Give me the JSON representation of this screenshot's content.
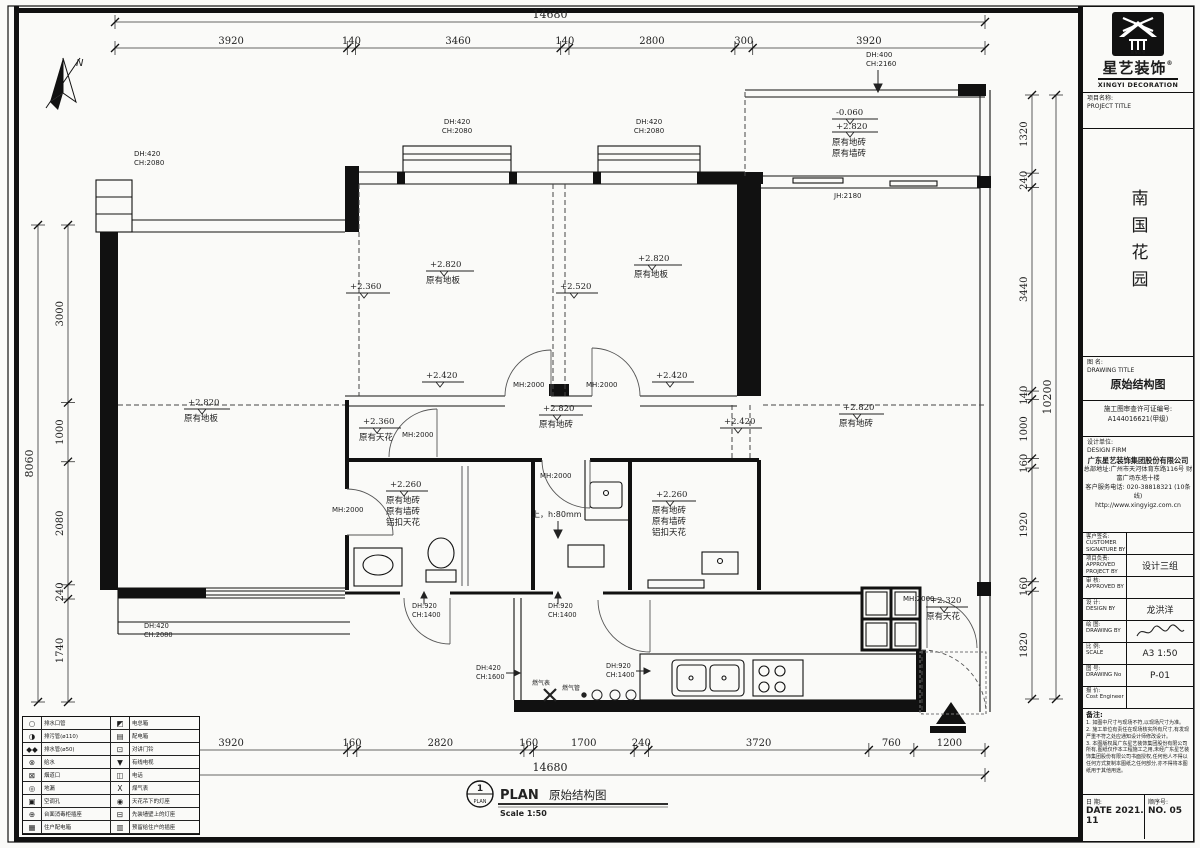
{
  "north_label": "N",
  "dims": {
    "top": {
      "total": "14680",
      "segments": [
        "3920",
        "140",
        "3460",
        "140",
        "2800",
        "300",
        "3920"
      ]
    },
    "bottom": {
      "total": "14680",
      "segments": [
        "3920",
        "160",
        "2820",
        "160",
        "1700",
        "240",
        "3720",
        "760",
        "1200"
      ]
    },
    "left": {
      "total": "8060",
      "segments": [
        "3000",
        "1000",
        "2080",
        "240",
        "1740"
      ]
    },
    "right": {
      "total": "10200",
      "segments": [
        "1320",
        "240",
        "3440",
        "140",
        "1000",
        "160",
        "1920",
        "160",
        "1820"
      ]
    }
  },
  "openings": {
    "win_tl": [
      "DH:420",
      "CH:2080"
    ],
    "bayA": [
      "DH:420",
      "CH:2080"
    ],
    "bayB": [
      "DH:420",
      "CH:2080"
    ],
    "balc": [
      "DH:400",
      "CH:2160"
    ],
    "jh": "JH:2180",
    "mh": "MH:2000",
    "d_bath1": [
      "DH:920",
      "CH:1400"
    ],
    "d_hall": [
      "DH:920",
      "CH:1400"
    ],
    "w_kit": [
      "DH:420",
      "CH:1600"
    ],
    "d_kit": [
      "DH:920",
      "CH:1400"
    ],
    "win_bl": [
      "DH:420",
      "CH:2080"
    ]
  },
  "levels": {
    "bedA": {
      "lv": "+2.820",
      "floor": "原有地板"
    },
    "bedA_edge": "+2.360",
    "bedB": {
      "lv": "+2.820",
      "floor": "原有地板"
    },
    "bedB_edge": "+2.520",
    "doorA_lv": "+2.420",
    "doorB_lv": "+2.420",
    "right_edge_lv": "+2.420",
    "balcony": {
      "lv1": "-0.060",
      "lv2": "+2.820",
      "t1": "原有地砖",
      "t2": "原有墙砖"
    },
    "living": {
      "lv": "+2.820",
      "floor": "原有地板"
    },
    "hall": {
      "lv": "+2.360",
      "ceil": "原有天花"
    },
    "dining": {
      "lv": "+2.820",
      "floor": "原有地砖"
    },
    "rightroom": {
      "lv": "+2.820",
      "floor": "原有地砖"
    },
    "bath1": {
      "lv": "+2.260",
      "t1": "原有地砖",
      "t2": "原有墙砖",
      "t3": "铝扣天花"
    },
    "bath2": {
      "lv": "+2.260",
      "t1": "原有地砖",
      "t2": "原有墙砖",
      "t3": "铝扣天花"
    },
    "entry": {
      "lv": "+2.320",
      "ceil": "原有天花"
    },
    "step": "上，h:80mm",
    "gas_meter": "燃气表",
    "gas_pipe": "燃气管"
  },
  "plan_title": {
    "num": "1",
    "sub": "PLAN",
    "name": "PLAN",
    "cn": "原始结构图",
    "scale": "Scale 1:50"
  },
  "legend": {
    "rows": [
      {
        "i1": "○",
        "t1": "排水口管",
        "i2": "◩",
        "t2": "电总箱"
      },
      {
        "i1": "◑",
        "t1": "排污管(ø110)",
        "i2": "▤",
        "t2": "配电箱"
      },
      {
        "i1": "◆◆",
        "t1": "排水管(ø50)",
        "i2": "⊡",
        "t2": "对讲门铃"
      },
      {
        "i1": "⊗",
        "t1": "给水",
        "i2": "▼",
        "t2": "有线电视"
      },
      {
        "i1": "⊠",
        "t1": "烟道口",
        "i2": "◫",
        "t2": "电话"
      },
      {
        "i1": "◎",
        "t1": "地漏",
        "i2": "X",
        "t2": "煤气表"
      },
      {
        "i1": "▣",
        "t1": "空调孔",
        "i2": "◉",
        "t2": "天花吊下的灯座"
      },
      {
        "i1": "⊕",
        "t1": "台面消毒柜插座",
        "i2": "⊟",
        "t2": "先装墙壁上的灯座"
      },
      {
        "i1": "▦",
        "t1": "住户配电箱",
        "i2": "▥",
        "t2": "预留给住户的插座"
      }
    ]
  },
  "title_block": {
    "logo": {
      "cn": "星艺装饰",
      "reg": "®",
      "en": "XINGYI DECORATION",
      "box": "XING YI"
    },
    "project_label": "项目名称:",
    "project_label_en": "PROJECT TITLE",
    "project_name": "南国花园",
    "drawing_label": "图 名:",
    "drawing_label_en": "DRAWING TITLE",
    "drawing_title": "原始结构图",
    "permit_label": "施工图审查许可证编号:",
    "permit_no": "A144016621(甲级)",
    "firm_label": "设计单位:",
    "firm_label_en": "DESIGN FIRM",
    "firm_name": "广东星艺装饰集团股份有限公司",
    "firm_addr": "总部地址:广州市天河体育东路116号 财富广场东塔十楼",
    "firm_tel": "客户服务电话: 020-38818321 (10条线)",
    "firm_web": "http://www.xingyigz.com.cn",
    "rows": [
      {
        "label": "客户签名:",
        "en": "CUSTOMER SIGNATURE BY",
        "value": ""
      },
      {
        "label": "项目负责:",
        "en": "APPROVED PROJECT BY",
        "value": "设计三组"
      },
      {
        "label": "审 核:",
        "en": "APPROVED BY",
        "value": ""
      },
      {
        "label": "设 计:",
        "en": "DESIGN BY",
        "value": "龙洪洋"
      },
      {
        "label": "绘 图:",
        "en": "DRAWING BY",
        "value": ""
      },
      {
        "label": "比 例:",
        "en": "SCALE",
        "value": "A3 1:50"
      },
      {
        "label": "图 号:",
        "en": "DRAWING No",
        "value": "P-01"
      },
      {
        "label": "报 价:",
        "en": "Cost Engineer",
        "value": ""
      }
    ],
    "notes_label": "备注:",
    "notes": [
      "1. 如图中尺寸与现场不符,以现场尺寸为准。",
      "2. 施工单位有责任在现场核实所有尺寸,有发现严重不符之处应通知设计师修改设计。",
      "3. 本图版权属广东星艺装饰集团股份有限公司所有,图纸仅作本工程施工之用,未经广东星艺装饰集团股份有限公司书面授权,任何他人不得以任何方式复制本图纸之任何部分,亦不得将本图纸用于其他用途。"
    ],
    "date_label": "日 期:",
    "date_en": "DATE",
    "date_value": "2021. 11",
    "seq_label": "顺序号:",
    "seq_en": "NO.",
    "seq_value": "05"
  }
}
